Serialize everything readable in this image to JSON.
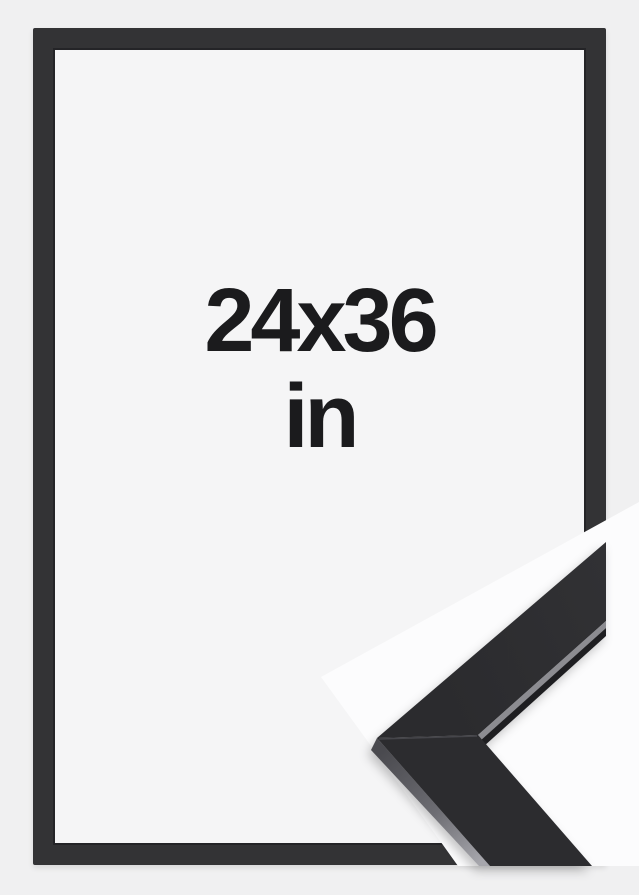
{
  "product_image": {
    "size_label": {
      "dimensions": "24x36",
      "unit": "in"
    }
  },
  "colors": {
    "page_background": "#f0f0f1",
    "frame_border": "#333335",
    "frame_interior": "#f5f5f6",
    "label_text": "#1b1b1d",
    "corner_photo_background": "#fcfcfd",
    "moulding_face_upper": "#2e2e31",
    "moulding_face_lower": "#2c2c2f",
    "moulding_side_highlight": "#8c8c91"
  }
}
